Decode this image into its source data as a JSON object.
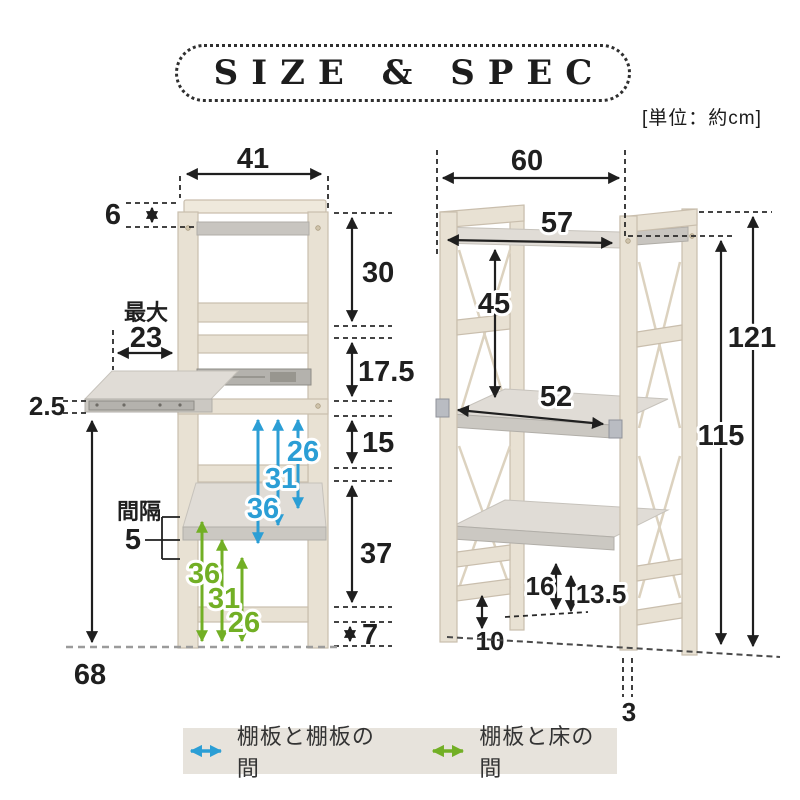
{
  "title": "SIZE & SPEC",
  "unit_note": "[単位：約cm]",
  "colors": {
    "blue_arrow": "#2b9ed5",
    "green_arrow": "#72af25",
    "frame_cream": "#e8e1d3",
    "legend_bg": "#e7e3dc"
  },
  "side_view": {
    "total_width": "41",
    "top_thickness": "6",
    "top_section": "30",
    "max_label": "最大",
    "max_extension": "23",
    "board_thickness": "2.5",
    "slide_section": "17.5",
    "mid_section": "15",
    "shelf_gap_26": "26",
    "shelf_gap_31": "31",
    "shelf_gap_36": "36",
    "interval_label": "間隔",
    "interval_value": "5",
    "floor_gap_36": "36",
    "floor_gap_31": "31",
    "floor_gap_26": "26",
    "lower_section": "37",
    "bottom_clearance": "7",
    "pullout_height": "68"
  },
  "front_view": {
    "total_width": "60",
    "top_shelf_width": "57",
    "top_to_mid_gap": "45",
    "mid_shelf_width": "52",
    "total_height": "121",
    "top_shelf_height": "115",
    "clearance_16": "16",
    "clearance_13_5": "13.5",
    "clearance_10": "10",
    "adjuster_height": "3"
  },
  "legend": {
    "shelf_to_shelf": "棚板と棚板の間",
    "shelf_to_floor": "棚板と床の間"
  }
}
